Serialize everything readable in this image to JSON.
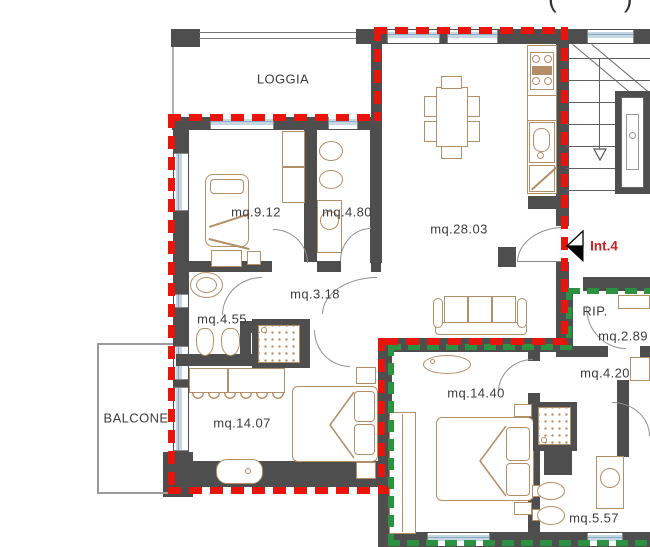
{
  "plan": {
    "header_fragment": "( )",
    "entrance": {
      "label": "Int.4",
      "color": "#cc2020"
    },
    "rooms": [
      {
        "id": "loggia",
        "label": "LOGGIA"
      },
      {
        "id": "bedroom1",
        "label": "mq.9.12"
      },
      {
        "id": "bath1",
        "label": "mq.4.80"
      },
      {
        "id": "living",
        "label": "mq.28.03"
      },
      {
        "id": "hallway",
        "label": "mq.3.18"
      },
      {
        "id": "bath2",
        "label": "mq.4.55"
      },
      {
        "id": "balcony",
        "label": "BALCONE"
      },
      {
        "id": "bedroom2",
        "label": "mq.14.07"
      },
      {
        "id": "bedroom3",
        "label": "mq.14.40"
      },
      {
        "id": "storage",
        "label": "RIP."
      },
      {
        "id": "storage-area",
        "label": "mq.2.89"
      },
      {
        "id": "hallway2",
        "label": "mq.4.20"
      },
      {
        "id": "bath3",
        "label": "mq.5.57"
      }
    ],
    "colors": {
      "wall": "#4e4e4e",
      "boundary_red": "#e9150d",
      "boundary_green": "#2c9140",
      "furniture": "#b38e66",
      "glazing": "#c6d7e4",
      "glazing_line": "#86abc6",
      "label_text": "#3c3c3c"
    }
  }
}
